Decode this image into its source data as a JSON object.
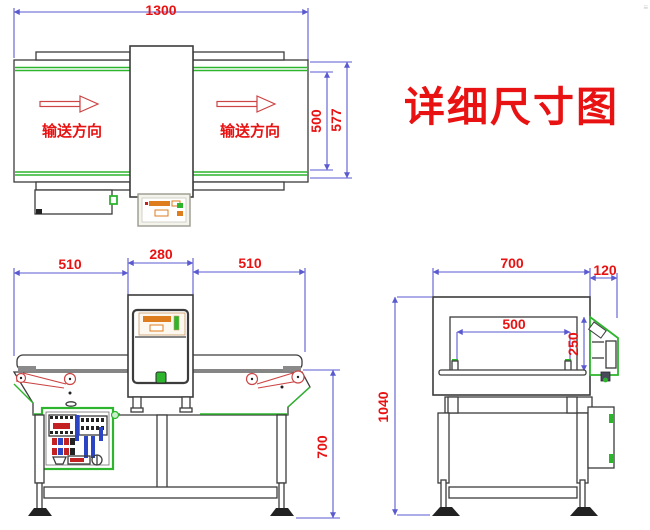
{
  "title": {
    "text": "详细尺寸图"
  },
  "colors": {
    "dimension_line": "#5a5ad0",
    "dimension_text": "#e81212",
    "drawing_line": "#3c3c3c",
    "accent_green": "#2db52d",
    "belt_red": "#cc4444",
    "panel_orange": "#de7d1e"
  },
  "top_view": {
    "name": "conveyor plan view",
    "dim_total_length": "1300",
    "dim_belt_width": "500",
    "dim_frame_width": "577",
    "flow_direction_left": "输送方向",
    "flow_direction_right": "输送方向"
  },
  "front_view": {
    "name": "conveyor front view",
    "dim_left_conveyor": "510",
    "dim_detector_width": "280",
    "dim_right_conveyor": "510",
    "dim_belt_height": "700"
  },
  "side_view": {
    "name": "conveyor side view",
    "dim_body_width": "700",
    "dim_panel_depth": "120",
    "dim_aperture_width": "500",
    "dim_aperture_height": "250",
    "dim_total_height": "1040"
  }
}
